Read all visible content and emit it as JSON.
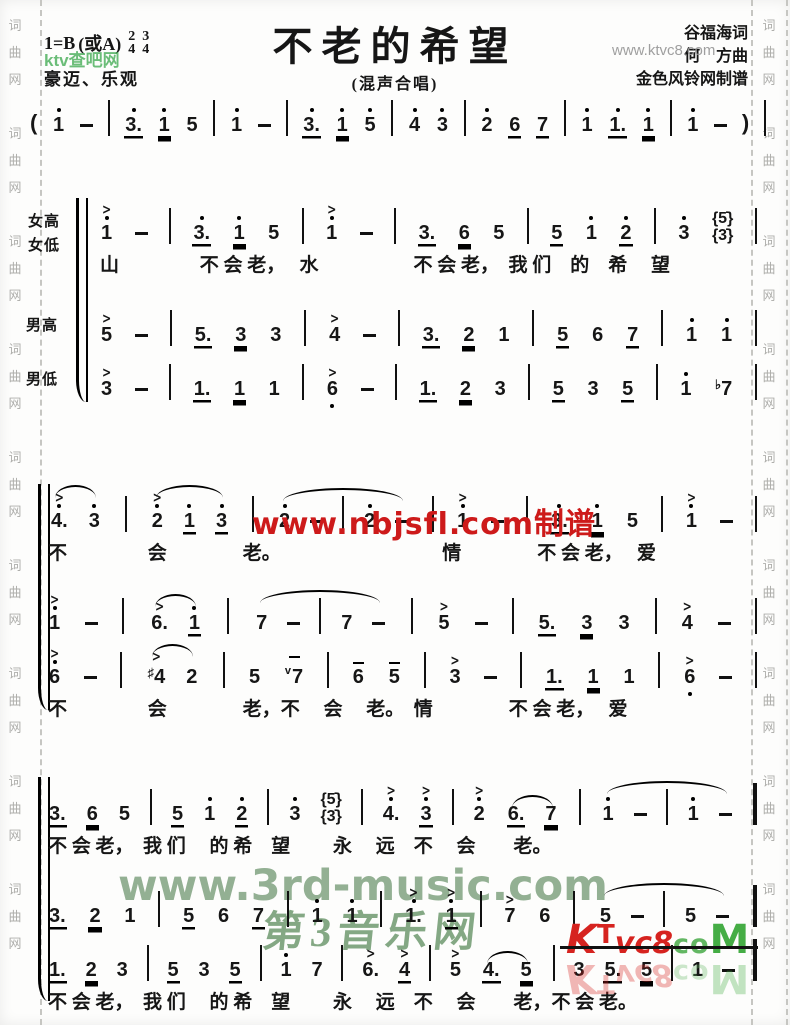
{
  "header": {
    "key": "1=B",
    "key_alt": "(或A)",
    "meters": [
      [
        "2",
        "4"
      ],
      [
        "3",
        "4"
      ]
    ],
    "mood": "豪迈、乐观",
    "title": "不老的希望",
    "subtitle": "(混声合唱)",
    "lyricist": "谷福海词",
    "composer": "何　方曲",
    "transcriber": "金色风铃网制谱"
  },
  "watermarks": {
    "top_left_green": "ktv查吧网",
    "top_right_gray": "www.ktvc8.com",
    "mid_red": "www.nbjsfl.com制谱",
    "green_url": "www.3rd-music.com",
    "green_name": "第3音乐网",
    "logo_k": "K",
    "logo_t": "T",
    "logo_vc8": "vc8",
    "logo_co": "co",
    "logo_m": "M",
    "edge_text": "词曲网"
  },
  "intro": {
    "cells": [
      "(",
      "1'",
      "-",
      "|",
      "3.'_",
      "1'__",
      "5",
      "|",
      "1'",
      "-",
      "|",
      "3.'_",
      "1'__",
      "5'",
      "|",
      "4'",
      "3'",
      "|",
      "2'",
      "6_",
      "7_",
      "|",
      "1'",
      "1.'_",
      "1'__",
      "|",
      "1'",
      "-",
      ")",
      "|"
    ]
  },
  "systems": [
    {
      "labels": [
        "女高",
        "女低",
        "男高",
        "男低"
      ],
      "rows": [
        {
          "type": "music",
          "cells": [
            "1'>",
            "-",
            "|",
            "3.'_",
            "1'__",
            "5",
            "|",
            "1'>",
            "-",
            "|",
            "3._",
            "6__",
            "5",
            "|",
            "5_",
            "1'",
            "2'_",
            "|",
            "3'",
            "{5',3'}",
            "|"
          ]
        },
        {
          "type": "lyrics",
          "text": "山　　　　 不 会 老，　 水　　　　　不 会 老，　我 们　的　希　 望"
        },
        {
          "type": "music",
          "cells": [
            "5>",
            "-",
            "|",
            "5._",
            "3__",
            "3",
            "|",
            "4>",
            "-",
            "|",
            "3._",
            "2__",
            "1",
            "|",
            "5_",
            "6",
            "7_",
            "|",
            "1'",
            "1'",
            "|"
          ]
        },
        {
          "type": "music",
          "cells": [
            "3>",
            "-",
            "|",
            "1._",
            "1__",
            "1",
            "|",
            "6,>",
            "-",
            "|",
            "1._",
            "2__",
            "3",
            "|",
            "5_",
            "3",
            "5_",
            "|",
            "1'",
            "b7",
            "|"
          ]
        }
      ]
    },
    {
      "rows": [
        {
          "type": "music",
          "cells": [
            "T(",
            "4.'>",
            "3'",
            "T)",
            "|",
            "T(",
            "2'>",
            "1'_",
            "3'_",
            "T)",
            "|",
            "T(",
            "2'",
            "-",
            "|",
            "2'",
            "-",
            "T)",
            "|",
            "1'>",
            "-",
            "|",
            "3.'_",
            "1'__",
            "5",
            "|",
            "1'>",
            "-",
            "|"
          ]
        },
        {
          "type": "lyrics",
          "text": "不　　　　 会　　　　老。　　　　　　　　　情　　　　不 会 老，　 爱"
        },
        {
          "type": "music",
          "cells": [
            "1'>",
            "-",
            "|",
            "T(",
            "6.>",
            "1'_",
            "T)",
            "|",
            "T(",
            "7",
            "-",
            "|",
            "7",
            "-",
            "T)",
            "|",
            "5>",
            "-",
            "|",
            "5._",
            "3__",
            "3",
            "|",
            "4>",
            "-",
            "|"
          ]
        },
        {
          "type": "music",
          "cells": [
            "6'>",
            "-",
            "|",
            "T(",
            "#4>",
            "2",
            "T)",
            "|",
            "5",
            "v7m",
            "|",
            "6m",
            "5m",
            "|",
            "3>",
            "-",
            "|",
            "1._",
            "1__",
            "1",
            "|",
            "6,>",
            "-",
            "|"
          ]
        },
        {
          "type": "lyrics",
          "text": "不　　　　 会　　　　老，不　 会　 老。　情　　　　不 会 老，　 爱"
        }
      ]
    },
    {
      "rows": [
        {
          "type": "music",
          "cells": [
            "3._",
            "6__",
            "5",
            "|",
            "5_",
            "1'",
            "2'_",
            "|",
            "3'",
            "{5',3'}",
            "|",
            "4.'>",
            "3'_>",
            "|",
            "2'>",
            "T(",
            "6._",
            "7__",
            "T)",
            "|",
            "T(",
            "1'",
            "-",
            "|",
            "1'",
            "-",
            "T)",
            "||"
          ]
        },
        {
          "type": "lyrics",
          "text": "不 会 老，　我 们　 的 希　望　　 永　 远　不　 会　　老。"
        },
        {
          "type": "music",
          "cells": [
            "3._",
            "2__",
            "1",
            "|",
            "5_",
            "6",
            "7_",
            "|",
            "1'",
            "1'",
            "|",
            "1.'>",
            "1'_>",
            "|",
            "7>",
            "6",
            "|",
            "T(",
            "5",
            "-",
            "|",
            "5",
            "-",
            "T)",
            "||"
          ]
        },
        {
          "type": "music",
          "cells": [
            "1._",
            "2__",
            "3",
            "|",
            "5_",
            "3",
            "5_",
            "|",
            "1'",
            "7",
            "|",
            "6.>",
            "4_>",
            "|",
            "5>",
            "T(",
            "4._",
            "5__",
            "T)",
            "|",
            "3",
            "5._",
            "5__",
            "|",
            "1",
            "-",
            "||"
          ]
        },
        {
          "type": "lyrics",
          "text": "不 会 老，　我 们　 的 希　望　　 永　 远　不　 会　　老，不 会 老。"
        }
      ]
    }
  ]
}
